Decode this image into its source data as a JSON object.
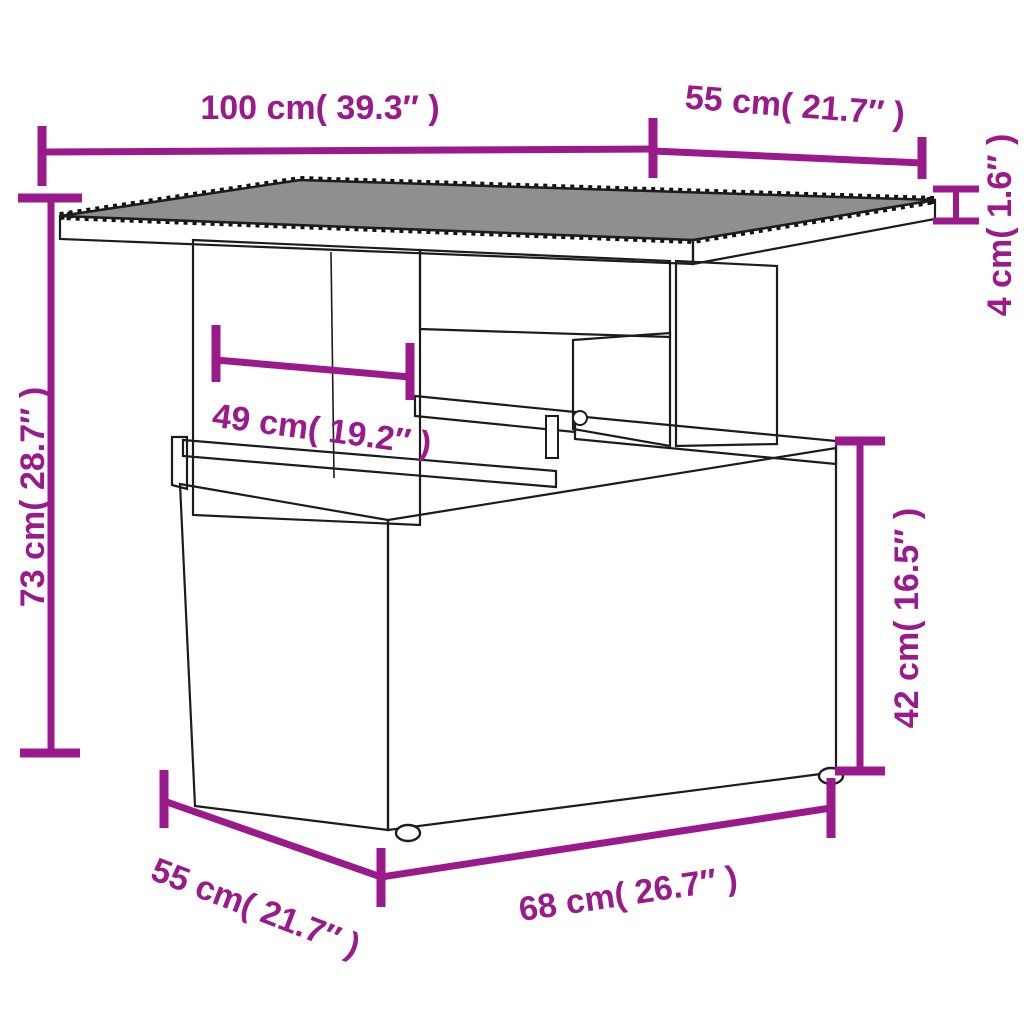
{
  "page": {
    "background_color": "#ffffff"
  },
  "diagram": {
    "type": "product-dimension-diagram",
    "subject": "poly rattan garden table with glass top nesting over a wicker storage box",
    "accent_color": "#9A1A8C",
    "line_color": "#1c1c1c",
    "glass_color": "#8f8f8f",
    "dimensions": [
      {
        "id": "tabletop-width",
        "label": "100 cm( 39.3″ )"
      },
      {
        "id": "tabletop-depth",
        "label": "55 cm( 21.7″ )"
      },
      {
        "id": "tabletop-thickness",
        "label": "4 cm( 1.6″ )"
      },
      {
        "id": "table-height",
        "label": "73 cm( 28.7″ )"
      },
      {
        "id": "pedestal-width",
        "label": "49 cm( 19.2″ )"
      },
      {
        "id": "box-height",
        "label": "42 cm( 16.5″ )"
      },
      {
        "id": "box-depth",
        "label": "55 cm( 21.7″ )"
      },
      {
        "id": "box-width",
        "label": "68 cm( 26.7″ )"
      }
    ]
  }
}
